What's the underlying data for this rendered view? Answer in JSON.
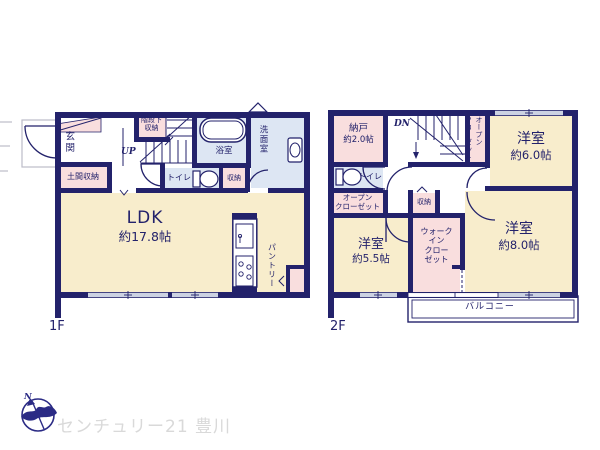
{
  "floor1": {
    "label": "1F",
    "rooms": {
      "genkan": "玄関",
      "doma_shuno": "土間収納",
      "kaidan_shita_line1": "階段下",
      "kaidan_shita_line2": "収納",
      "stairs_up": "UP",
      "bathroom": "浴室",
      "senmenshitsu": "洗面室",
      "toilet": "トイレ",
      "shuno": "収納",
      "ldk_name": "LDK",
      "ldk_size": "約17.8帖",
      "pantry": "パントリー"
    }
  },
  "floor2": {
    "label": "2F",
    "rooms": {
      "nando_name": "納戸",
      "nando_size": "約2.0帖",
      "stairs_dn": "DN",
      "toilet": "トイレ",
      "open_closet_left_line1": "オープン",
      "open_closet_left_line2": "クローゼット",
      "shuno": "収納",
      "open_closet_right_line1": "オープン",
      "open_closet_right_line2": "クローゼット",
      "yoshitsu6_name": "洋室",
      "yoshitsu6_size": "約6.0帖",
      "yoshitsu55_name": "洋室",
      "yoshitsu55_size": "約5.5帖",
      "wic_line1": "ウォーク",
      "wic_line2": "イン",
      "wic_line3": "クロー",
      "wic_line4": "ゼット",
      "yoshitsu8_name": "洋室",
      "yoshitsu8_size": "約8.0帖",
      "balcony": "バルコニー"
    }
  },
  "footer": {
    "compass_north": "N",
    "brand": "センチュリー21 豊川"
  },
  "colors": {
    "wall_navy": "#23226b",
    "room_cream": "#f8edcc",
    "room_pink": "#f9dede",
    "room_blue": "#dde6f3",
    "window_gray": "#ccd2e2",
    "porch_gray": "#bcbcc8",
    "watermark_gray": "#d9d9d9",
    "compass_navy": "#2b2b85"
  }
}
